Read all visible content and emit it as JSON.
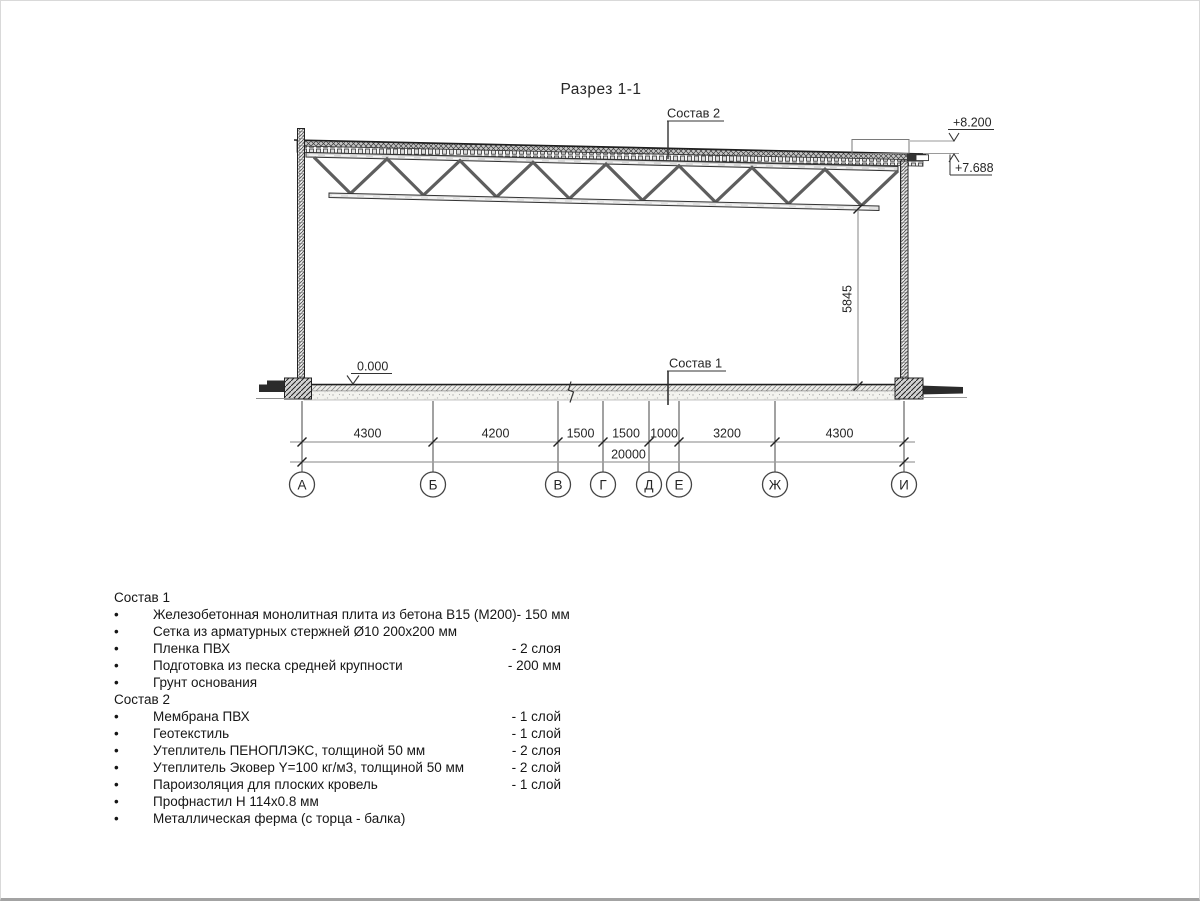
{
  "title": "Разрез 1-1",
  "bullet": "•",
  "callouts": {
    "sostav2": "Состав 2",
    "sostav1": "Состав 1"
  },
  "levels": {
    "zero": "0.000",
    "roof_high": "+8.200",
    "roof_low": "+7.688"
  },
  "dims": {
    "spans": [
      "4300",
      "4200",
      "1500",
      "1500",
      "1000",
      "3200",
      "4300"
    ],
    "total": "20000",
    "height": "5845"
  },
  "axes": [
    "А",
    "Б",
    "В",
    "Г",
    "Д",
    "Е",
    "Ж",
    "И"
  ],
  "specs": [
    {
      "heading": "Состав 1",
      "items": [
        {
          "name": "Железобетонная монолитная плита из бетона В15 (М200)",
          "value": "-  150 мм"
        },
        {
          "name": "Сетка из арматурных стержней Ø10 200х200 мм",
          "value": ""
        },
        {
          "name": "Пленка ПВХ",
          "value": "-  2 слоя"
        },
        {
          "name": "Подготовка из песка средней крупности",
          "value": "- 200 мм"
        },
        {
          "name": "Грунт основания",
          "value": ""
        }
      ]
    },
    {
      "heading": "Состав 2",
      "items": [
        {
          "name": "Мембрана ПВХ",
          "value": "- 1 слой"
        },
        {
          "name": "Геотекстиль",
          "value": "- 1 слой"
        },
        {
          "name": "Утеплитель ПЕНОПЛЭКС, толщиной 50 мм",
          "value": "- 2 слоя"
        },
        {
          "name": "Утеплитель Эковер Y=100 кг/м3, толщиной 50 мм",
          "value": "- 2 слой"
        },
        {
          "name": "Пароизоляция для плоских кровель",
          "value": "- 1 слой"
        },
        {
          "name": "Профнастил Н 114х0.8 мм",
          "value": ""
        },
        {
          "name": "Металлическая ферма (с торца - балка)",
          "value": ""
        }
      ]
    }
  ]
}
